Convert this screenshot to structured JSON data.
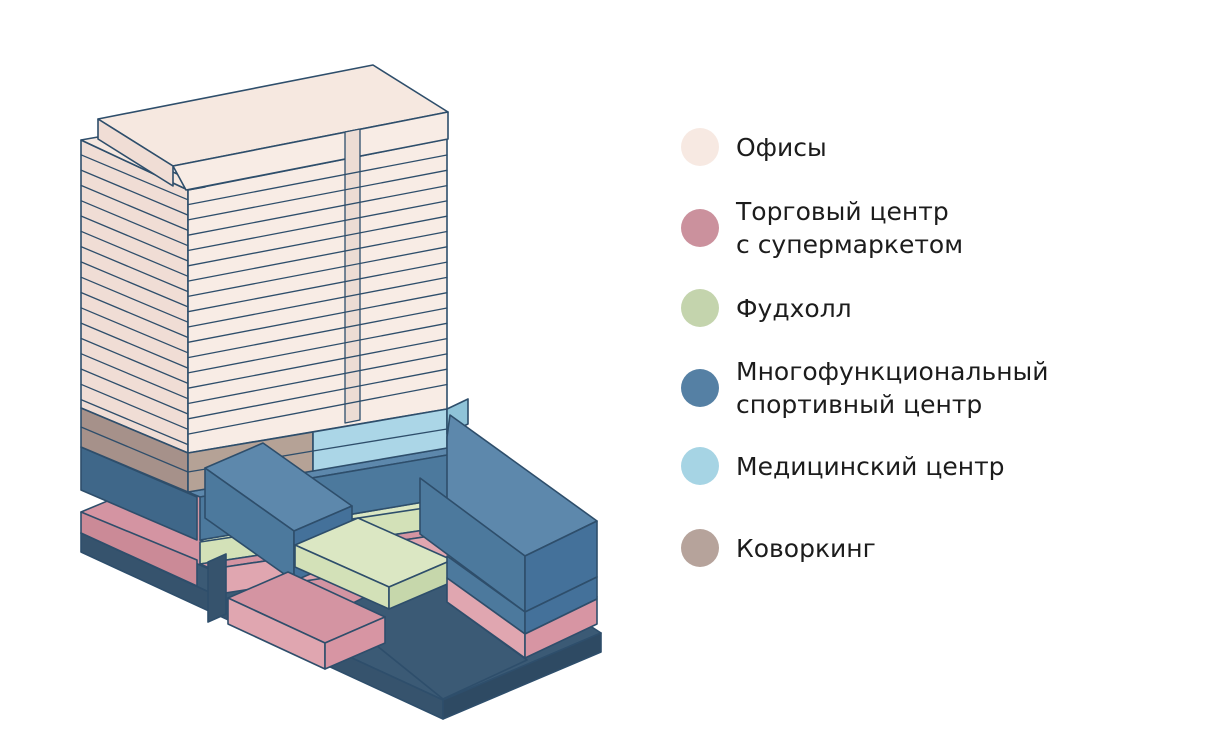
{
  "legend": {
    "items": [
      {
        "id": "offices",
        "label": "Офисы",
        "lines": [
          "Офисы",
          ""
        ],
        "color": "#f7e9e2"
      },
      {
        "id": "mall",
        "label": "Торговый центр с супермаркетом",
        "lines": [
          "Торговый центр",
          "с супермаркетом"
        ],
        "color": "#cb919d"
      },
      {
        "id": "foodhall",
        "label": "Фудхолл",
        "lines": [
          "Фудхолл",
          ""
        ],
        "color": "#c4d4ad"
      },
      {
        "id": "sport",
        "label": "Многофункциональный спортивный центр",
        "lines": [
          "Многофункциональный",
          "спортивный центр"
        ],
        "color": "#5580a4"
      },
      {
        "id": "medical",
        "label": "Медицинский центр",
        "lines": [
          "Медицинский центр",
          ""
        ],
        "color": "#a6d4e4"
      },
      {
        "id": "coworking",
        "label": "Коворкинг",
        "lines": [
          "Коворкинг",
          ""
        ],
        "color": "#b6a39b"
      }
    ]
  },
  "colors": {
    "outline": "#2e4e6b",
    "cream_top": "#f6e8e0",
    "cream_front": "#f8ece5",
    "cream_left": "#f0ddd5",
    "cream_seam": "#ecdcd4",
    "taupe_front": "#b5a296",
    "taupe_left": "#a6918a",
    "medical_front": "#abd6e7",
    "medical_side": "#8fc3d8",
    "blue_top": "#5d88ac",
    "blue_front": "#4c799d",
    "blue_left": "#3f6789",
    "blue_end": "#44719a",
    "green_top": "#dbe7c3",
    "green_front": "#d3e1b8",
    "green_left": "#b9cd9d",
    "green_end": "#c6d7ab",
    "pink_top": "#d494a2",
    "pink_front": "#e0a6b0",
    "pink_left": "#cb8a97",
    "pink_end": "#d795a3",
    "base_top": "#3b5a75",
    "base_left": "#36536d",
    "base_right": "#2e4a63",
    "background": "#ffffff"
  }
}
